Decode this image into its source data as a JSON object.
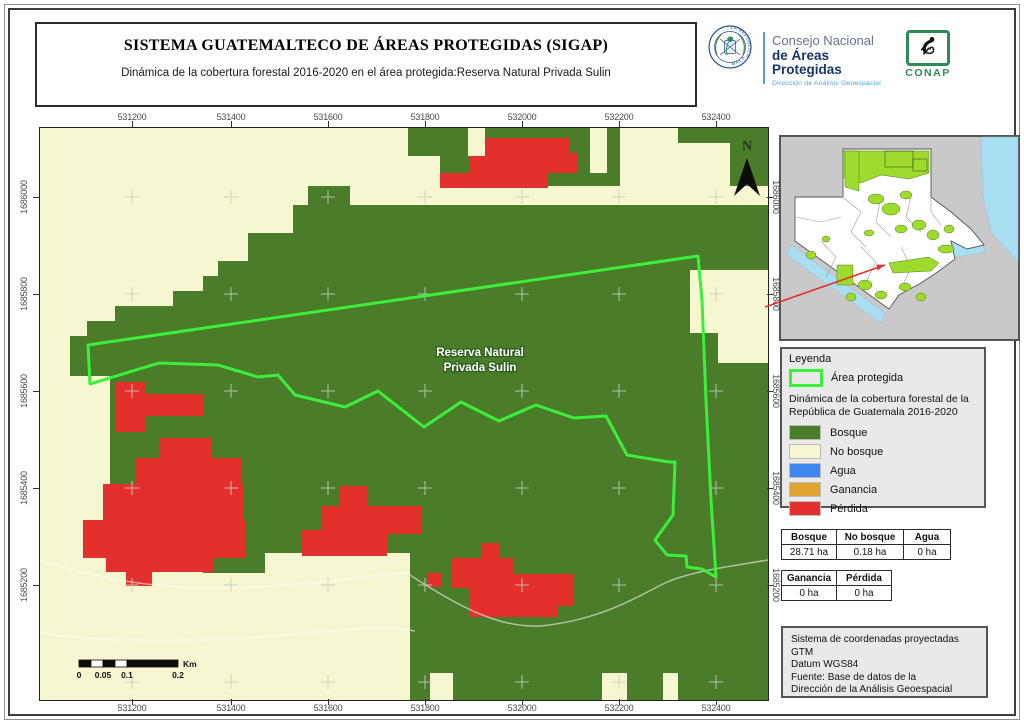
{
  "header": {
    "title": "SISTEMA GUATEMALTECO DE ÁREAS PROTEGIDAS  (SIGAP)",
    "subtitle": "Dinámica de la cobertura forestal 2016-2020 en el área protegida:Reserva Natural Privada Sulin"
  },
  "logos": {
    "seal_text_top": "GOBIERNO DE LA REPÚBLICA",
    "seal_text_bottom": "GUATEMALA",
    "org_line1": "Consejo Nacional",
    "org_line2": "de Áreas Protegidas",
    "org_line3": "Dirección de Análisis Geoespacial",
    "conap_label": "CONAP"
  },
  "colors": {
    "bosque": "#4a7c2a",
    "no_bosque": "#f6f6d0",
    "agua": "#3e86f0",
    "ganancia": "#e0a230",
    "perdida": "#e3302c",
    "boundary": "#3bf03b",
    "inset_protected": "#9fdb2d",
    "inset_water": "#a9dff2",
    "inset_land": "#ffffff",
    "inset_bg": "#c9c9c9",
    "cross": "#c9cfc2",
    "trail": "#ffffff"
  },
  "axes": {
    "x_values": [
      "531200",
      "531400",
      "531600",
      "531800",
      "532000",
      "532200",
      "532400"
    ],
    "x_px": [
      132,
      231,
      328,
      425,
      522,
      619,
      716
    ],
    "y_values": [
      "1686000",
      "1685800",
      "1685600",
      "1685400",
      "1685200"
    ],
    "y_px": [
      197,
      294,
      391,
      488,
      585
    ]
  },
  "map": {
    "place_label_line1": "Reserva Natural",
    "place_label_line2": "Privada Sulin",
    "north_label": "N",
    "green_bands": [
      [
        368,
        0,
        360,
        58
      ],
      [
        268,
        58,
        42,
        20
      ],
      [
        253,
        77,
        475,
        28
      ],
      [
        208,
        105,
        520,
        28
      ],
      [
        178,
        133,
        550,
        16
      ],
      [
        163,
        148,
        565,
        16
      ],
      [
        133,
        163,
        595,
        16
      ],
      [
        75,
        178,
        653,
        16
      ],
      [
        47,
        193,
        681,
        16
      ],
      [
        30,
        208,
        698,
        40
      ],
      [
        70,
        248,
        658,
        177
      ],
      [
        370,
        425,
        358,
        147
      ],
      [
        163,
        425,
        62,
        20
      ]
    ],
    "yellow_patches": [
      [
        428,
        0,
        17,
        28
      ],
      [
        550,
        0,
        17,
        45
      ],
      [
        580,
        0,
        58,
        62
      ],
      [
        638,
        15,
        52,
        47
      ],
      [
        368,
        28,
        32,
        30
      ],
      [
        650,
        142,
        78,
        63
      ],
      [
        678,
        205,
        50,
        30
      ],
      [
        390,
        545,
        23,
        27
      ],
      [
        562,
        545,
        25,
        27
      ],
      [
        623,
        545,
        15,
        27
      ]
    ],
    "red_patches": [
      [
        445,
        10,
        85,
        20
      ],
      [
        430,
        28,
        78,
        32
      ],
      [
        400,
        45,
        75,
        15
      ],
      [
        505,
        25,
        32,
        20
      ],
      [
        76,
        254,
        30,
        50
      ],
      [
        106,
        266,
        58,
        22
      ],
      [
        120,
        310,
        52,
        26
      ],
      [
        95,
        330,
        107,
        30
      ],
      [
        63,
        356,
        140,
        38
      ],
      [
        43,
        392,
        162,
        38
      ],
      [
        66,
        430,
        108,
        14
      ],
      [
        86,
        443,
        26,
        15
      ],
      [
        300,
        358,
        28,
        22
      ],
      [
        282,
        378,
        100,
        28
      ],
      [
        262,
        402,
        85,
        26
      ],
      [
        442,
        415,
        18,
        16
      ],
      [
        412,
        430,
        62,
        30
      ],
      [
        472,
        446,
        62,
        32
      ],
      [
        430,
        459,
        88,
        30
      ],
      [
        388,
        445,
        14,
        14
      ]
    ],
    "boundary_path": "M48,217 L658,128 L662,172 L666,272 L671,372 L676,449 L662,441 L647,439 L646,428 L627,427 L615,412 L633,387 L635,334 L629,334 L587,327 L566,288 L534,290 L496,277 L459,293 L421,274 L384,299 L338,263 L305,279 L255,267 L238,247 L218,249 L178,237 L119,235 L50,256 Z",
    "trails": [
      "M0,432 C90,462 160,462 235,458 C300,454 335,446 367,445 C420,480 460,500 500,498 C560,492 595,470 625,455 C652,443 692,438 728,432",
      "M0,505 C90,518 200,512 290,503 C330,499 355,499 375,503"
    ],
    "cross_x": [
      92,
      191,
      288,
      385,
      482,
      579,
      676
    ],
    "cross_y": [
      69,
      166,
      263,
      360,
      457,
      554
    ],
    "label_x": 440,
    "label_y1": 228,
    "label_y2": 243,
    "north_x": 707,
    "north_y": 22,
    "north_polygon": "707,30 694,68 707,56 720,68"
  },
  "scalebar": {
    "y": 532,
    "h": 7,
    "segments": [
      [
        39,
        12,
        "#0b0b0b"
      ],
      [
        51,
        12,
        "#ffffff"
      ],
      [
        63,
        12,
        "#0b0b0b"
      ],
      [
        75,
        12,
        "#ffffff"
      ],
      [
        87,
        51,
        "#0b0b0b"
      ]
    ],
    "tick_labels": [
      [
        "0",
        39
      ],
      [
        "0.05",
        63
      ],
      [
        "0.1",
        87
      ],
      [
        "0.2",
        138
      ]
    ],
    "unit": "Km",
    "unit_x": 143
  },
  "inset": {
    "country_path": "M62,12 L150,12 L150,60 L170,75 L190,92 L203,108 L186,112 L170,104 L174,122 L158,134 L140,146 L118,158 L108,172 L14,104 L14,60 L62,60 Z",
    "sea_paths": [
      "M200,0 L237,0 L237,125 L210,95 L202,60 Z",
      "M165,100 L195,95 L205,115 L175,120 Z",
      "M10,108 L104,176 L100,186 L6,118 Z"
    ],
    "green_paths": [
      "M62,14 L148,14 L148,36 L128,42 L100,38 L80,46 L62,40 Z",
      "M64,14 L78,14 L78,54 L64,50 Z",
      "M108,126 L148,120 L158,126 L150,134 L112,136 Z",
      "M56,128 L72,128 L72,148 L56,148 Z"
    ],
    "green_blobs": [
      [
        95,
        62,
        8,
        5
      ],
      [
        110,
        72,
        9,
        6
      ],
      [
        125,
        58,
        6,
        4
      ],
      [
        138,
        88,
        7,
        5
      ],
      [
        120,
        92,
        6,
        4
      ],
      [
        152,
        98,
        6,
        5
      ],
      [
        168,
        92,
        5,
        4
      ],
      [
        30,
        118,
        5,
        4
      ],
      [
        45,
        102,
        4,
        3
      ],
      [
        88,
        96,
        5,
        3
      ],
      [
        165,
        112,
        8,
        4
      ],
      [
        84,
        148,
        7,
        5
      ],
      [
        100,
        158,
        6,
        4
      ],
      [
        124,
        150,
        6,
        4
      ],
      [
        140,
        160,
        5,
        4
      ],
      [
        70,
        160,
        5,
        4
      ]
    ],
    "frame_rects": [
      [
        104,
        14,
        28,
        16
      ],
      [
        132,
        22,
        14,
        12
      ]
    ],
    "dept_lines": [
      "M62,60 L80,75 L70,95 L85,110",
      "M100,60 L95,85 L110,100",
      "M130,60 L125,80 L140,95",
      "M14,80 L40,85 L60,80",
      "M40,104 L55,120 L45,140",
      "M80,110 L95,125 L85,145",
      "M120,110 L130,130 L122,148",
      "M150,60 L150,75 L160,88"
    ],
    "arrow": {
      "x1": -16,
      "y1": 170,
      "x2": 104,
      "y2": 128
    },
    "arrow_head": "104,128 96.5,133.5 95.5,127.5"
  },
  "legend": {
    "title": "Leyenda",
    "area_label": "Área protegida",
    "subtitle_line1": "Dinámica de la cobertura forestal de la",
    "subtitle_line2": "República de Guatemala 2016-2020",
    "items": [
      {
        "label": "Bosque",
        "color": "#4a7c2a"
      },
      {
        "label": "No bosque",
        "color": "#f6f6d0"
      },
      {
        "label": "Agua",
        "color": "#3e86f0"
      },
      {
        "label": "Ganancia",
        "color": "#e0a230"
      },
      {
        "label": "Pérdida",
        "color": "#e3302c"
      }
    ]
  },
  "tables": {
    "coverage": {
      "headers": [
        "Bosque",
        "No bosque",
        "Agua"
      ],
      "values": [
        "28.71 ha",
        "0.18 ha",
        "0 ha"
      ],
      "col_widths": [
        46,
        58,
        38
      ]
    },
    "change": {
      "headers": [
        "Ganancia",
        "Pérdida"
      ],
      "values": [
        "0 ha",
        "0 ha"
      ],
      "col_widths": [
        46,
        46
      ]
    }
  },
  "info_box": {
    "lines": [
      "Sistema de coordenadas proyectadas",
      "GTM",
      "Datum WGS84",
      "Fuente: Base de datos de la",
      "Dirección de la Análisis Geoespacial"
    ]
  }
}
